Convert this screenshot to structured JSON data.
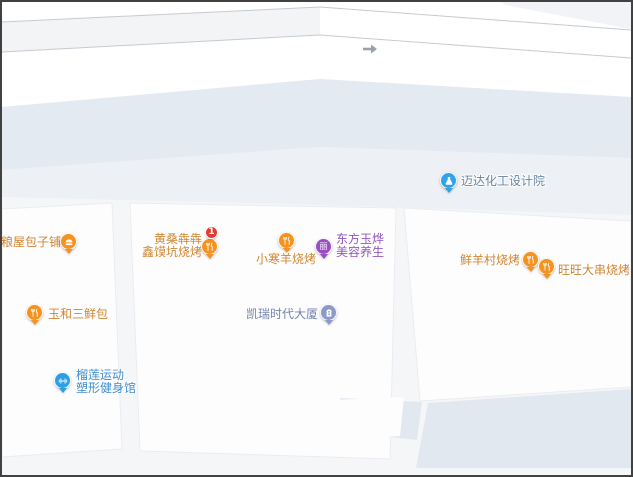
{
  "map": {
    "type": "street-map",
    "road_arrow": "traffic-direction-right",
    "palette": {
      "map_base": "#f5f6f8",
      "road_white": "#ffffff",
      "avenue_band": "#e4eaf1",
      "avenue_band_light": "#edf1f6",
      "road_line": "#c6cad0",
      "building_white": "#fdfdfe",
      "building_blue": "#e2e8f0",
      "food_pin": "#f6921e",
      "food_text": "#cf8430",
      "beauty_pin": "#984fc4",
      "beauty_text": "#9156bd",
      "company_pin": "#31a3e6",
      "company_text": "#66839f",
      "building_pin": "#8b9ac8",
      "building_text": "#6f81ab",
      "fitness_pin": "#2d9fe3",
      "fitness_text": "#3f8ccc",
      "badge_red": "#e23c32"
    }
  },
  "pois": {
    "maida": {
      "name": "迈达化工设计院",
      "category": "company",
      "icon": "flask-icon"
    },
    "baozi": {
      "name": "古粮屋包子铺",
      "category": "food",
      "icon": "bun-icon"
    },
    "huangsang": {
      "lines": [
        "黄桑犇犇",
        "鑫馍坑烧烤"
      ],
      "category": "food",
      "icon": "restaurant-icon",
      "badge": "1"
    },
    "xiaohan": {
      "name": "小寒羊烧烤",
      "category": "food",
      "icon": "restaurant-icon"
    },
    "dongfang": {
      "lines": [
        "东方玉烨",
        "美容养生"
      ],
      "category": "beauty",
      "icon": "beauty-icon",
      "icon_glyph": "丽"
    },
    "xianyangcun": {
      "name": "鲜羊村烧烤",
      "category": "food",
      "icon": "restaurant-icon"
    },
    "wangwang": {
      "name": "旺旺大串烧烤",
      "category": "food",
      "icon": "restaurant-icon"
    },
    "yuhe": {
      "name": "玉和三鲜包",
      "category": "food",
      "icon": "restaurant-icon"
    },
    "kairui": {
      "name": "凯瑞时代大厦",
      "category": "building",
      "icon": "office-building-icon"
    },
    "liulian": {
      "lines": [
        "榴莲运动",
        "塑形健身馆"
      ],
      "category": "fitness",
      "icon": "dumbbell-icon"
    }
  }
}
